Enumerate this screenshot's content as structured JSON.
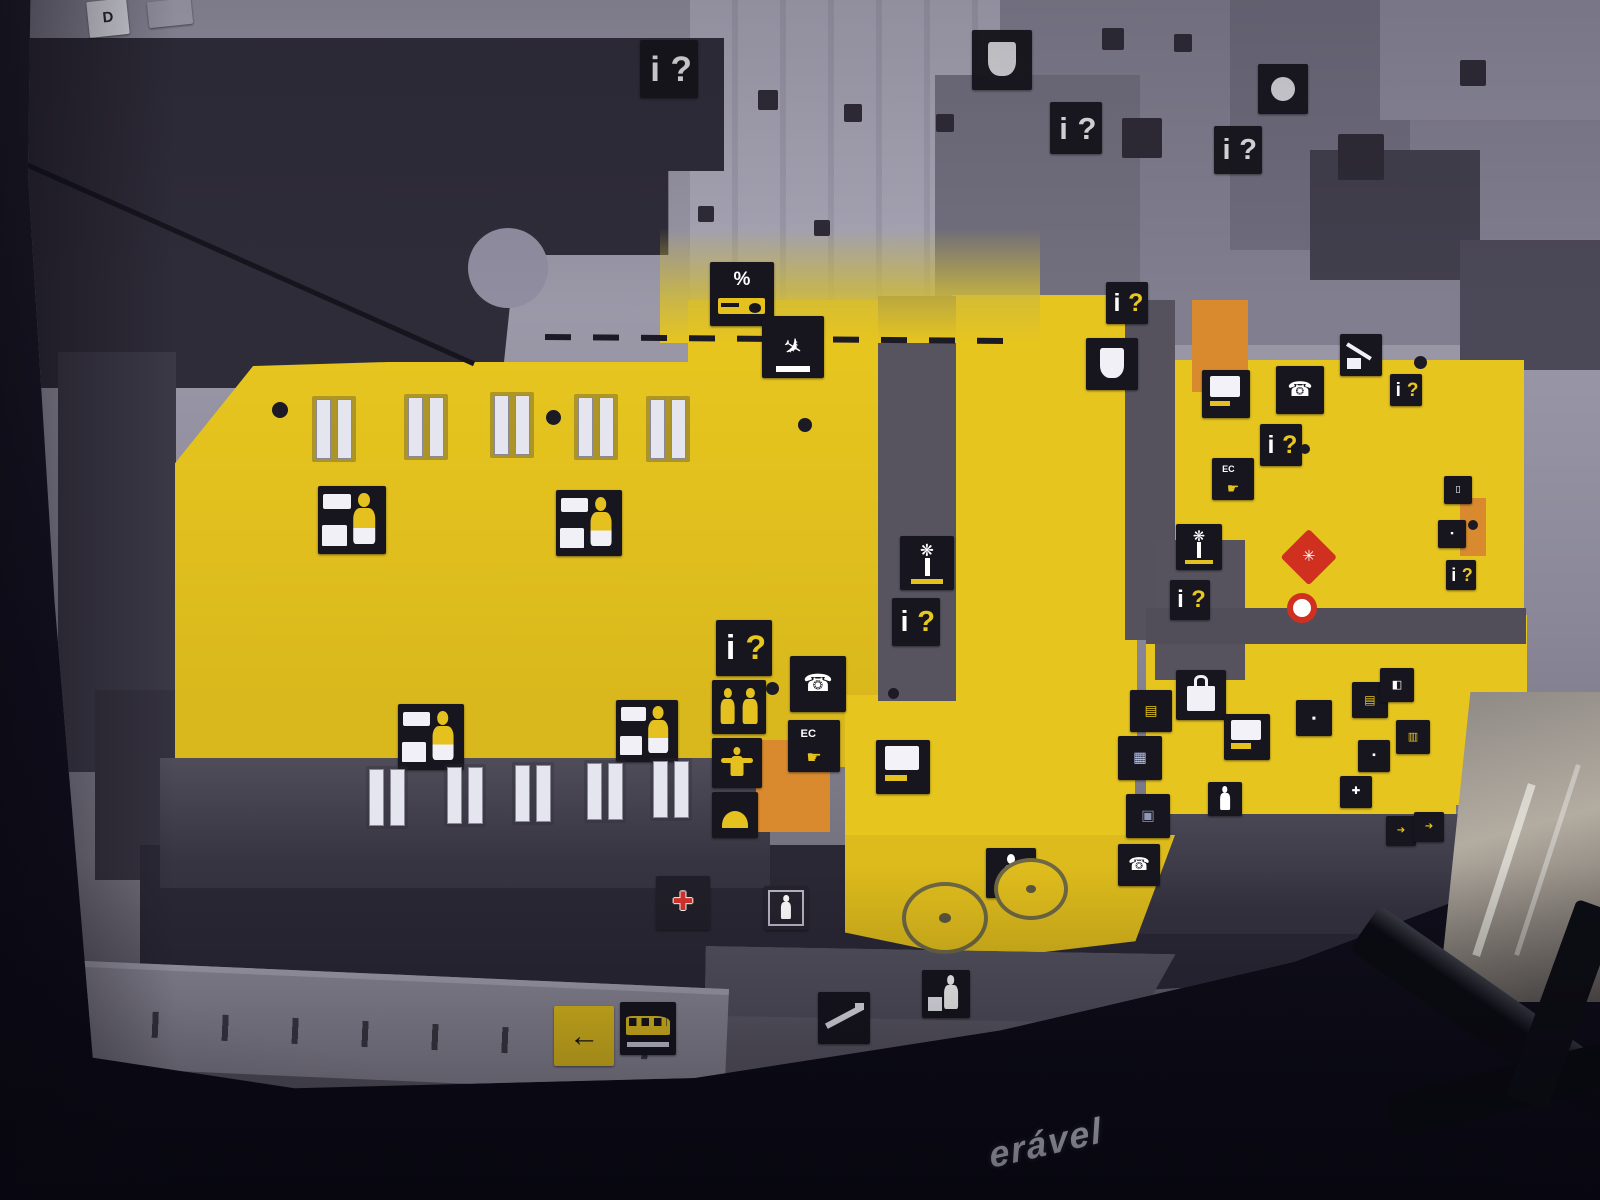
{
  "scene": {
    "caption_fragment": "erável",
    "corner_tag": "D"
  },
  "palette": {
    "floor_yellow": "#e7c51f",
    "board_grey": "#908da0",
    "wall_dark": "#2f2c39",
    "icon_black": "#17151e",
    "accent_orange": "#d98a2e",
    "marker_red": "#d03020",
    "glyph_yellow": "#e8c81e",
    "caption_color": "#d2d3e0"
  },
  "icons": [
    {
      "name": "gate-tag",
      "kind": "tag",
      "glyph": "D",
      "x": 88,
      "y": 0,
      "s": 40,
      "rot": -6
    },
    {
      "name": "blank-tag",
      "kind": "tagblank",
      "x": 148,
      "y": 0,
      "s": 44,
      "rot": -6
    },
    {
      "name": "info-icon",
      "kind": "info",
      "glyph": "i?",
      "x": 640,
      "y": 40,
      "s": 58,
      "qc": "#ffffff",
      "dim": true
    },
    {
      "name": "cafe-cup-icon",
      "kind": "cup",
      "x": 972,
      "y": 30,
      "s": 60,
      "dim": true
    },
    {
      "name": "info-icon",
      "kind": "info",
      "glyph": "i?",
      "x": 1050,
      "y": 102,
      "s": 52,
      "qc": "#ffffff",
      "dim": true
    },
    {
      "name": "info-icon",
      "kind": "info",
      "glyph": "i?",
      "x": 1214,
      "y": 126,
      "s": 48,
      "qc": "#ffffff",
      "dim": true
    },
    {
      "name": "circle-icon",
      "kind": "dotcircle",
      "x": 1258,
      "y": 64,
      "s": 50,
      "dim": true
    },
    {
      "name": "duty-free-percent-icon",
      "kind": "percent",
      "glyph": "%",
      "x": 710,
      "y": 262,
      "s": 64
    },
    {
      "name": "arrivals-plane-icon",
      "kind": "plane",
      "glyph": "✈",
      "x": 762,
      "y": 316,
      "s": 62
    },
    {
      "name": "check-in-icon",
      "kind": "checkin",
      "x": 318,
      "y": 486,
      "s": 68
    },
    {
      "name": "check-in-icon",
      "kind": "checkin",
      "x": 556,
      "y": 490,
      "s": 66
    },
    {
      "name": "check-in-icon",
      "kind": "checkin",
      "x": 398,
      "y": 704,
      "s": 66
    },
    {
      "name": "check-in-icon",
      "kind": "checkin",
      "x": 616,
      "y": 700,
      "s": 62
    },
    {
      "name": "info-icon",
      "kind": "info",
      "glyph": "i?",
      "x": 716,
      "y": 620,
      "s": 56
    },
    {
      "name": "toilets-icon",
      "kind": "wc",
      "x": 712,
      "y": 680,
      "s": 54
    },
    {
      "name": "nursery-icon",
      "kind": "child",
      "x": 712,
      "y": 738,
      "s": 50
    },
    {
      "name": "restaurant-icon",
      "kind": "dome",
      "x": 712,
      "y": 792,
      "s": 46
    },
    {
      "name": "phone-icon",
      "kind": "phone",
      "glyph": "☎",
      "x": 790,
      "y": 656,
      "s": 56
    },
    {
      "name": "atm-icon",
      "kind": "atm",
      "glyph": "EC",
      "glyph2": "☛",
      "x": 788,
      "y": 720,
      "s": 52
    },
    {
      "name": "flight-info-screen-icon",
      "kind": "screen",
      "x": 876,
      "y": 740,
      "s": 54
    },
    {
      "name": "travel-agency-palm-icon",
      "kind": "palm",
      "glyph": "❋",
      "x": 900,
      "y": 536,
      "s": 54
    },
    {
      "name": "info-icon",
      "kind": "info",
      "glyph": "i?",
      "x": 892,
      "y": 598,
      "s": 48
    },
    {
      "name": "info-icon",
      "kind": "info",
      "glyph": "i?",
      "x": 1106,
      "y": 282,
      "s": 42
    },
    {
      "name": "cafe-cup-icon",
      "kind": "cup",
      "x": 1086,
      "y": 338,
      "s": 52
    },
    {
      "name": "flight-info-screen-icon",
      "kind": "screen",
      "x": 1202,
      "y": 370,
      "s": 48
    },
    {
      "name": "phone-icon",
      "kind": "phone",
      "glyph": "☎",
      "x": 1276,
      "y": 366,
      "s": 48
    },
    {
      "name": "info-icon",
      "kind": "info",
      "glyph": "i?",
      "x": 1260,
      "y": 424,
      "s": 42
    },
    {
      "name": "atm-icon",
      "kind": "atm",
      "glyph": "EC",
      "glyph2": "☛",
      "x": 1212,
      "y": 458,
      "s": 42
    },
    {
      "name": "baggage-trolley-icon",
      "kind": "trolley",
      "x": 1340,
      "y": 334,
      "s": 42
    },
    {
      "name": "info-icon",
      "kind": "info",
      "glyph": "i?",
      "x": 1390,
      "y": 374,
      "s": 32
    },
    {
      "name": "travel-agency-palm-icon",
      "kind": "palm",
      "glyph": "❋",
      "x": 1176,
      "y": 524,
      "s": 46
    },
    {
      "name": "info-icon",
      "kind": "info",
      "glyph": "i?",
      "x": 1170,
      "y": 580,
      "s": 40
    },
    {
      "name": "you-are-here-marker",
      "kind": "marker-diamond",
      "glyph": "✳",
      "x": 1286,
      "y": 534,
      "s": 46
    },
    {
      "name": "location-dot-marker",
      "kind": "marker-ring",
      "x": 1282,
      "y": 588,
      "s": 40
    },
    {
      "name": "shopping-bag-icon",
      "kind": "bag",
      "x": 1176,
      "y": 670,
      "s": 50
    },
    {
      "name": "shop-icon",
      "kind": "shop",
      "glyph": "▤",
      "c": "#e8c81e",
      "x": 1130,
      "y": 690,
      "s": 42
    },
    {
      "name": "shop-icon",
      "kind": "shop",
      "glyph": "▦",
      "c": "#bcd0ff",
      "x": 1118,
      "y": 736,
      "s": 44
    },
    {
      "name": "flight-info-screen-icon",
      "kind": "screen",
      "x": 1224,
      "y": 714,
      "s": 46
    },
    {
      "name": "shop-icon",
      "kind": "shop",
      "glyph": "▪",
      "c": "#ffffff",
      "x": 1296,
      "y": 700,
      "s": 36
    },
    {
      "name": "shop-icon",
      "kind": "shop",
      "glyph": "▤",
      "c": "#e8c81e",
      "x": 1352,
      "y": 682,
      "s": 36
    },
    {
      "name": "shop-icon",
      "kind": "shop",
      "glyph": "◧",
      "c": "#ffffff",
      "x": 1380,
      "y": 668,
      "s": 34
    },
    {
      "name": "shop-icon",
      "kind": "shop",
      "glyph": "▥",
      "c": "#e8c81e",
      "x": 1396,
      "y": 720,
      "s": 34
    },
    {
      "name": "shop-icon",
      "kind": "shop",
      "glyph": "▪",
      "c": "#ffffff",
      "x": 1358,
      "y": 740,
      "s": 32
    },
    {
      "name": "pharmacy-cross-icon",
      "kind": "shop",
      "glyph": "✚",
      "c": "#ffffff",
      "x": 1340,
      "y": 776,
      "s": 32
    },
    {
      "name": "shop-icon",
      "kind": "shop",
      "glyph": "▣",
      "c": "#8f96b8",
      "x": 1126,
      "y": 794,
      "s": 44
    },
    {
      "name": "stairs-person-icon",
      "kind": "person",
      "x": 1208,
      "y": 782,
      "s": 34
    },
    {
      "name": "walkway-person-icon",
      "kind": "person",
      "x": 986,
      "y": 848,
      "s": 50
    },
    {
      "name": "phone-icon",
      "kind": "phone",
      "glyph": "☎",
      "x": 1118,
      "y": 844,
      "s": 42
    },
    {
      "name": "first-aid-icon",
      "kind": "firstaid",
      "glyph": "✚",
      "x": 656,
      "y": 876,
      "s": 54
    },
    {
      "name": "elevator-icon",
      "kind": "lift",
      "x": 764,
      "y": 886,
      "s": 44
    },
    {
      "name": "escalator-icon",
      "kind": "esc",
      "x": 818,
      "y": 992,
      "s": 52
    },
    {
      "name": "porter-icon",
      "kind": "porter",
      "x": 922,
      "y": 970,
      "s": 48
    },
    {
      "name": "exit-arrow-sign",
      "kind": "arrowsign",
      "glyph": "←",
      "x": 554,
      "y": 1006,
      "s": 60
    },
    {
      "name": "bus-icon",
      "kind": "bus",
      "x": 620,
      "y": 1002,
      "s": 56
    },
    {
      "name": "round-counter",
      "kind": "floorcircle",
      "x": 902,
      "y": 882,
      "s": 86
    },
    {
      "name": "round-counter",
      "kind": "floorcircle",
      "x": 994,
      "y": 858,
      "s": 74
    },
    {
      "name": "luggage-icon",
      "kind": "shop",
      "glyph": "▯",
      "c": "#ffffff",
      "x": 1444,
      "y": 476,
      "s": 28
    },
    {
      "name": "shop-icon",
      "kind": "shop",
      "glyph": "▪",
      "c": "#ffffff",
      "x": 1438,
      "y": 520,
      "s": 28
    },
    {
      "name": "info-icon",
      "kind": "info",
      "glyph": "i?",
      "x": 1446,
      "y": 560,
      "s": 30
    },
    {
      "name": "direction-arrow-icon",
      "kind": "shop",
      "glyph": "➔",
      "c": "#e8c81e",
      "x": 1386,
      "y": 816,
      "s": 30
    },
    {
      "name": "direction-arrow-icon",
      "kind": "shop",
      "glyph": "➔",
      "c": "#e8c81e",
      "x": 1414,
      "y": 812,
      "s": 30
    },
    {
      "name": "check-in-desks",
      "kind": "door",
      "x": 312,
      "y": 396,
      "s": 44
    },
    {
      "name": "check-in-desks",
      "kind": "door",
      "x": 404,
      "y": 394,
      "s": 44
    },
    {
      "name": "check-in-desks",
      "kind": "door",
      "x": 490,
      "y": 392,
      "s": 44
    },
    {
      "name": "check-in-desks",
      "kind": "door",
      "x": 574,
      "y": 394,
      "s": 44
    },
    {
      "name": "check-in-desks",
      "kind": "door",
      "x": 646,
      "y": 396,
      "s": 44
    },
    {
      "name": "check-in-desks",
      "kind": "door",
      "x": 366,
      "y": 766,
      "s": 42
    },
    {
      "name": "check-in-desks",
      "kind": "door",
      "x": 444,
      "y": 764,
      "s": 42
    },
    {
      "name": "check-in-desks",
      "kind": "door",
      "x": 512,
      "y": 762,
      "s": 42
    },
    {
      "name": "check-in-desks",
      "kind": "door",
      "x": 584,
      "y": 760,
      "s": 42
    },
    {
      "name": "check-in-desks",
      "kind": "door",
      "x": 650,
      "y": 758,
      "s": 42
    },
    {
      "name": "vent-mark",
      "kind": "vent",
      "x": 758,
      "y": 90,
      "s": 20
    },
    {
      "name": "vent-mark",
      "kind": "vent",
      "x": 844,
      "y": 104,
      "s": 18
    },
    {
      "name": "vent-mark",
      "kind": "vent",
      "x": 936,
      "y": 114,
      "s": 18
    },
    {
      "name": "vent-mark",
      "kind": "vent",
      "x": 698,
      "y": 206,
      "s": 16
    },
    {
      "name": "vent-mark",
      "kind": "vent",
      "x": 814,
      "y": 220,
      "s": 16
    },
    {
      "name": "vent-mark",
      "kind": "vent",
      "x": 1102,
      "y": 28,
      "s": 22
    },
    {
      "name": "vent-mark",
      "kind": "vent",
      "x": 1174,
      "y": 34,
      "s": 18
    },
    {
      "name": "vent-mark",
      "kind": "vent",
      "x": 1338,
      "y": 134,
      "s": 46
    },
    {
      "name": "vent-mark",
      "kind": "vent",
      "x": 1122,
      "y": 118,
      "s": 40
    },
    {
      "name": "vent-mark",
      "kind": "vent",
      "x": 1460,
      "y": 60,
      "s": 26
    },
    {
      "name": "column-dot",
      "kind": "dot",
      "x": 272,
      "y": 402,
      "s": 16
    },
    {
      "name": "column-dot",
      "kind": "dot",
      "x": 546,
      "y": 410,
      "s": 15
    },
    {
      "name": "column-dot",
      "kind": "dot",
      "x": 798,
      "y": 418,
      "s": 14
    },
    {
      "name": "column-dot",
      "kind": "dot",
      "x": 766,
      "y": 682,
      "s": 13
    },
    {
      "name": "column-dot",
      "kind": "dot",
      "x": 1414,
      "y": 356,
      "s": 13
    },
    {
      "name": "column-dot",
      "kind": "dot",
      "x": 888,
      "y": 688,
      "s": 11
    },
    {
      "name": "column-dot",
      "kind": "dot",
      "x": 1300,
      "y": 444,
      "s": 10
    },
    {
      "name": "column-dot",
      "kind": "dot",
      "x": 1468,
      "y": 520,
      "s": 10
    }
  ]
}
